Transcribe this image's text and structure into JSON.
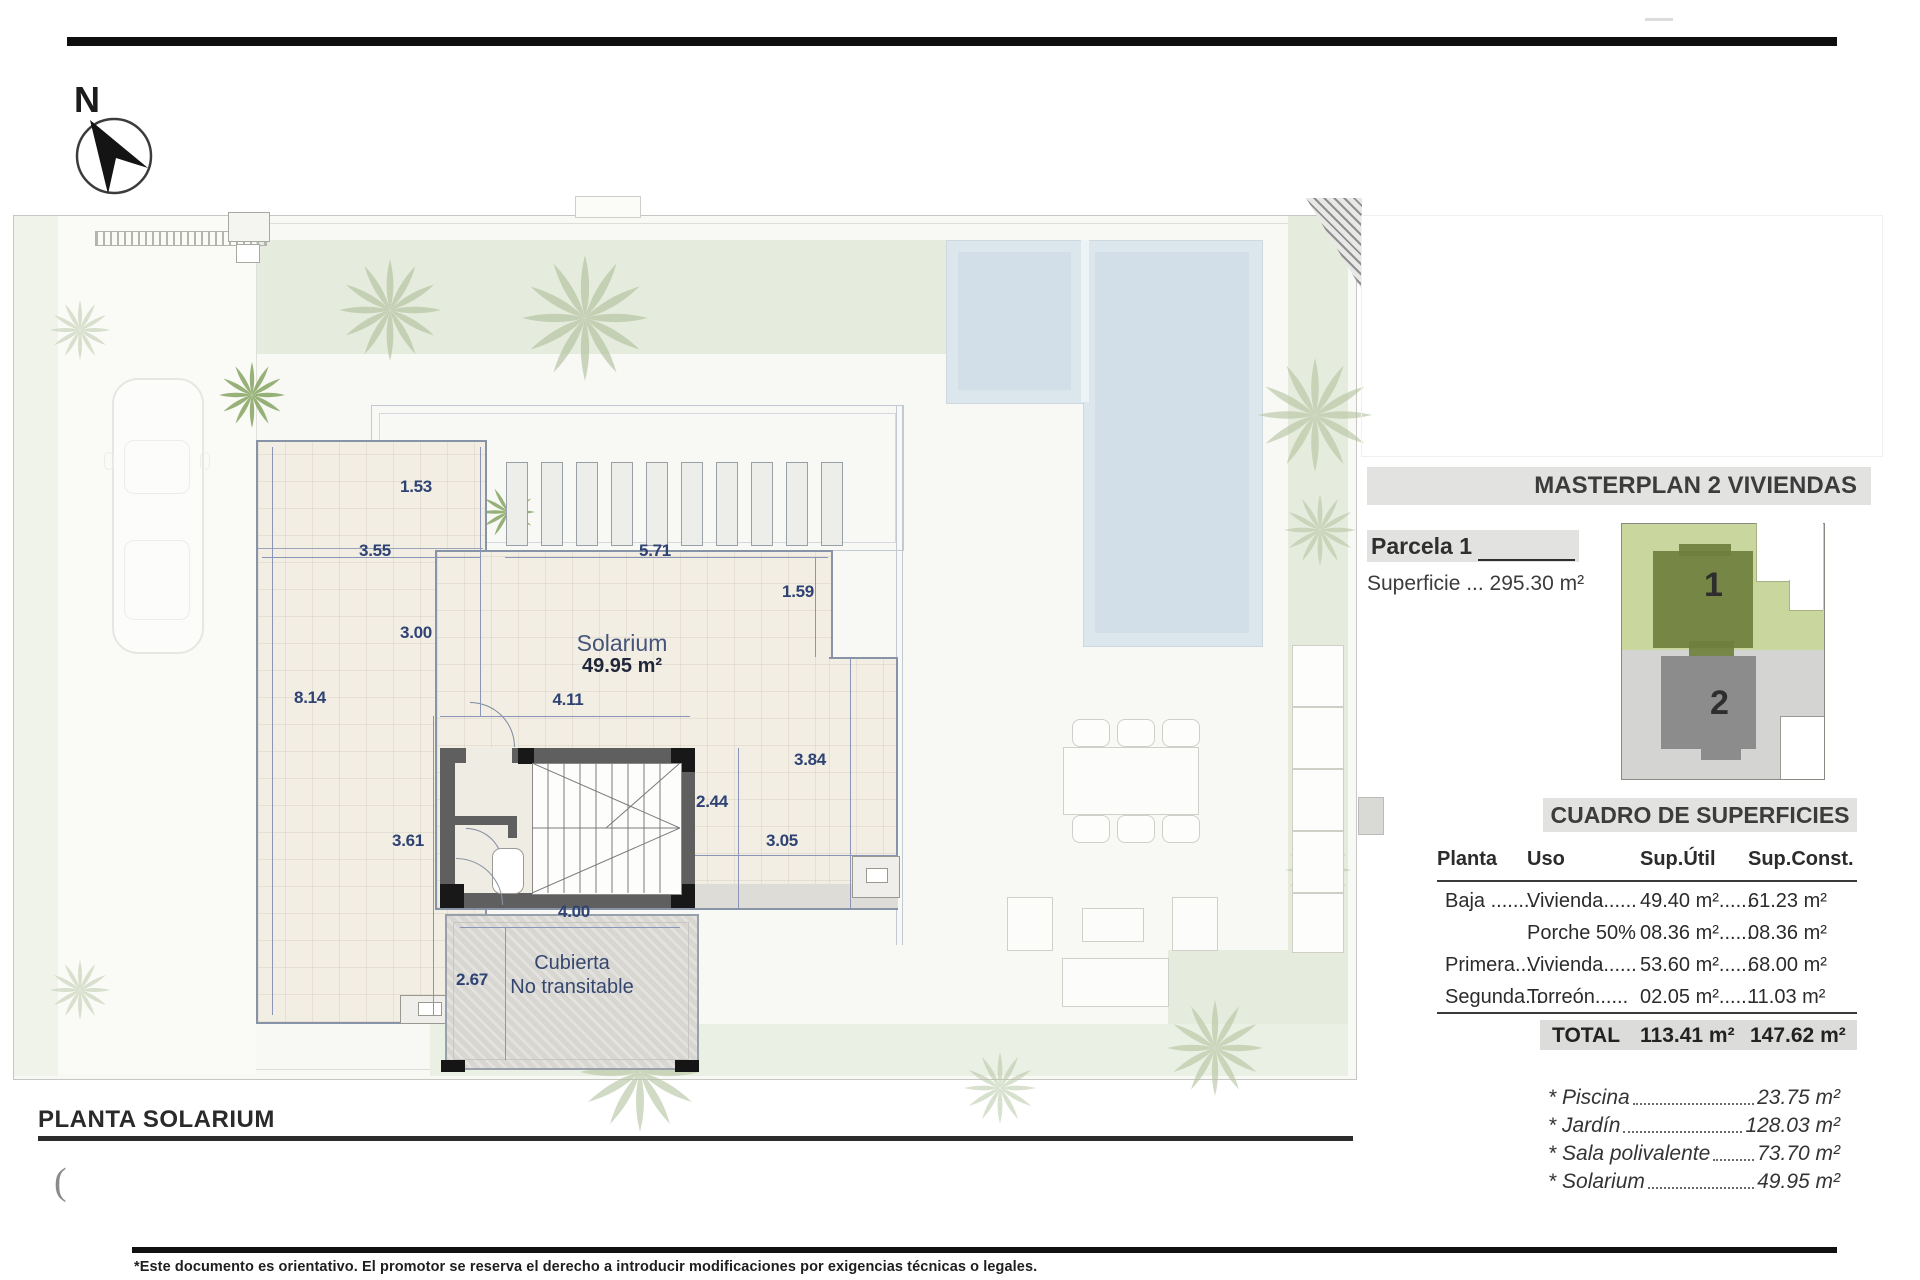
{
  "north_label": "N",
  "plan": {
    "title": "PLANTA SOLARIUM",
    "paren": "(",
    "solarium_label": "Solarium",
    "solarium_area": "49.95 m²",
    "cubierta_line1": "Cubierta",
    "cubierta_line2": "No transitable",
    "dims": {
      "d153": "1.53",
      "d355": "3.55",
      "d571": "5.71",
      "d159": "1.59",
      "d300": "3.00",
      "d814": "8.14",
      "d411": "4.11",
      "d244": "2.44",
      "d384": "3.84",
      "d361": "3.61",
      "d305": "3.05",
      "d400": "4.00",
      "d267": "2.67"
    }
  },
  "panel": {
    "masterplan_title": "MASTERPLAN 2 VIVIENDAS",
    "parcela_label": "Parcela 1",
    "superficie": "Superficie ... 295.30 m²",
    "plot1": "1",
    "plot2": "2",
    "cuadro_title": "CUADRO DE SUPERFICIES",
    "table": {
      "headers": [
        "Planta",
        "Uso",
        "Sup.Útil",
        "Sup.Const."
      ],
      "rows": [
        [
          "Baja ........",
          "Vivienda......",
          "49.40 m²......",
          "61.23 m²"
        ],
        [
          "",
          "Porche 50%",
          "08.36 m²......",
          "08.36 m²"
        ],
        [
          "Primera....",
          "Vivienda......",
          "53.60 m²......",
          "68.00 m²"
        ],
        [
          "Segunda...",
          "Torreón......",
          "02.05 m²......",
          "11.03 m²"
        ]
      ],
      "total_label": "TOTAL",
      "total_util": "113.41 m²",
      "total_const": "147.62 m²"
    },
    "extras": [
      {
        "label": "* Piscina",
        "value": "23.75 m²"
      },
      {
        "label": "* Jardín",
        "value": "128.03 m²"
      },
      {
        "label": "* Sala polivalente",
        "value": "73.70 m²"
      },
      {
        "label": "* Solarium",
        "value": "49.95 m²"
      }
    ]
  },
  "footer": {
    "disclaimer": "*Este documento es orientativo. El promotor se reserva el derecho a introducir modificaciones por exigencias técnicas o legales."
  },
  "colors": {
    "dim_text": "#2e4273",
    "terrace": "#f2eee3",
    "pool": "#dce6ed",
    "garden": "#e6ecdd",
    "plot1_green": "#6f7f3d",
    "plot2_gray": "#8c8c8c",
    "header_bar": "#e2e2e0"
  }
}
